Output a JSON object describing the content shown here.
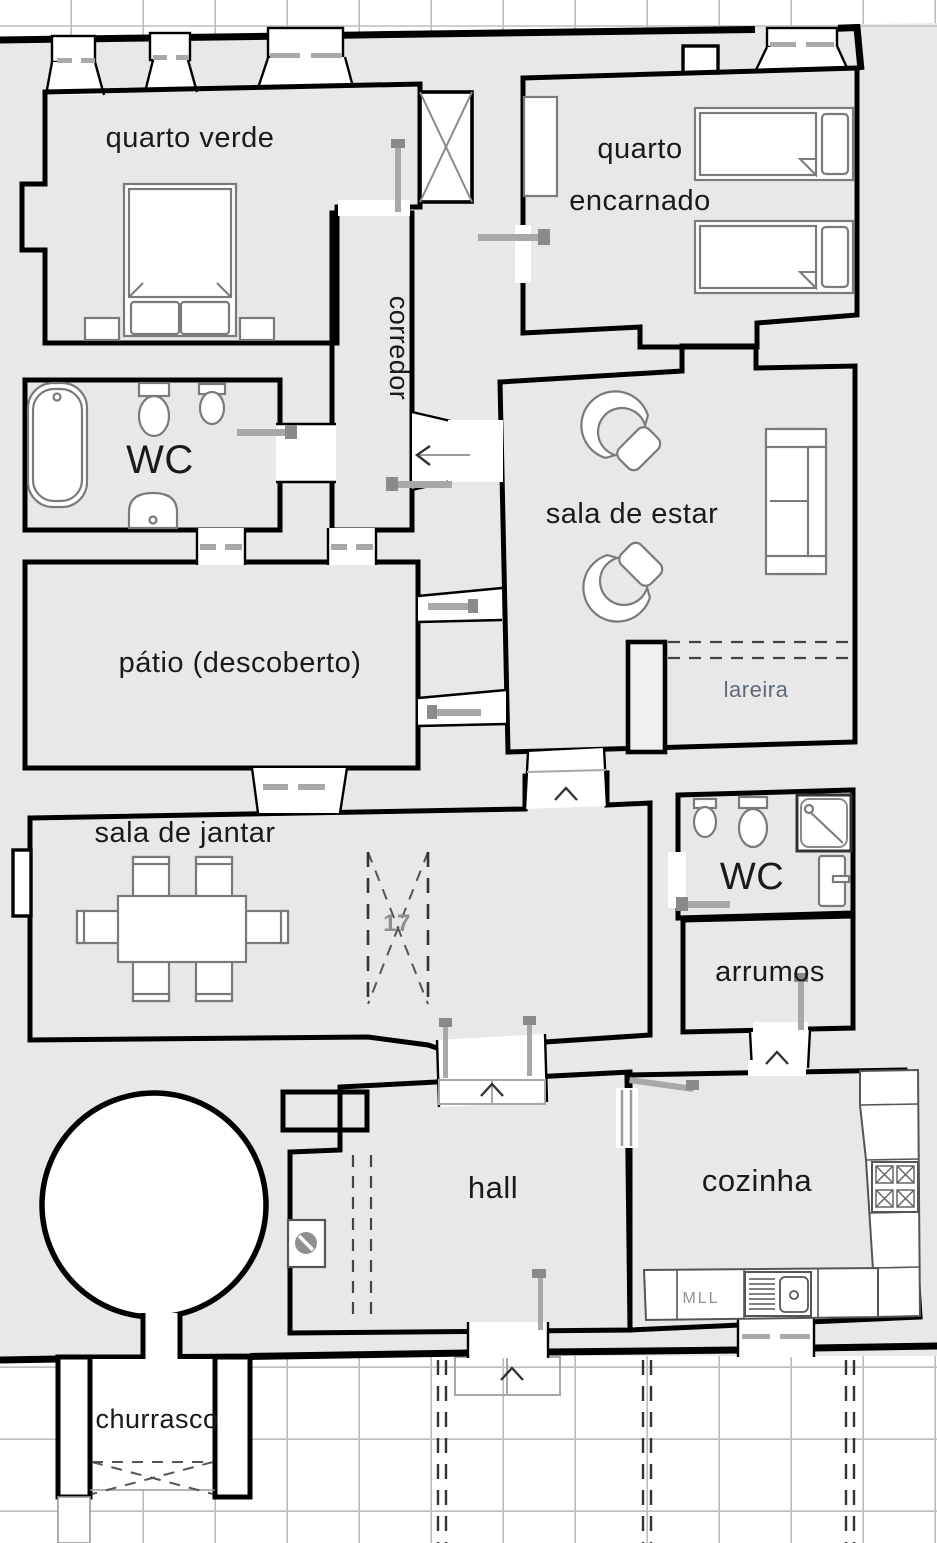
{
  "drawing": {
    "type": "architectural-floor-plan",
    "language": "pt",
    "rooms": {
      "quarto_verde": {
        "label": "quarto verde"
      },
      "quarto_encarnado": {
        "label_line1": "quarto",
        "label_line2": "encarnado"
      },
      "corredor": {
        "label": "corredor"
      },
      "wc_top": {
        "label": "WC"
      },
      "sala_de_estar": {
        "label": "sala de estar",
        "fireplace_label": "lareira"
      },
      "patio": {
        "label": "pátio (descoberto)"
      },
      "sala_de_jantar": {
        "label": "sala de jantar"
      },
      "passage": {
        "number": "17"
      },
      "wc_right": {
        "label": "WC"
      },
      "arrumos": {
        "label": "arrumos"
      },
      "hall": {
        "label": "hall"
      },
      "cozinha": {
        "label": "cozinha",
        "appliance_label": "MLL"
      },
      "churrasco": {
        "label": "churrasco"
      }
    },
    "fixtures": [
      "double-bed",
      "single-bed",
      "wardrobe",
      "bathtub",
      "toilet",
      "bidet",
      "washbasin",
      "shower",
      "armchair",
      "sofa",
      "dining-table",
      "dining-chair",
      "stove",
      "kitchen-sink",
      "counter",
      "water-heater",
      "dishwasher",
      "barbecue",
      "round-tank"
    ],
    "colors": {
      "background": "#e8e8e8",
      "wall": "#000000",
      "floor": "#ffffff",
      "tile_line": "#cdcdcd",
      "exterior_line": "#bdbdbd",
      "furniture": "#7a7a7a",
      "door": "#a8a8a8",
      "fireplace_label": "#5d6b7c",
      "number_label": "#8f8f8f"
    }
  }
}
